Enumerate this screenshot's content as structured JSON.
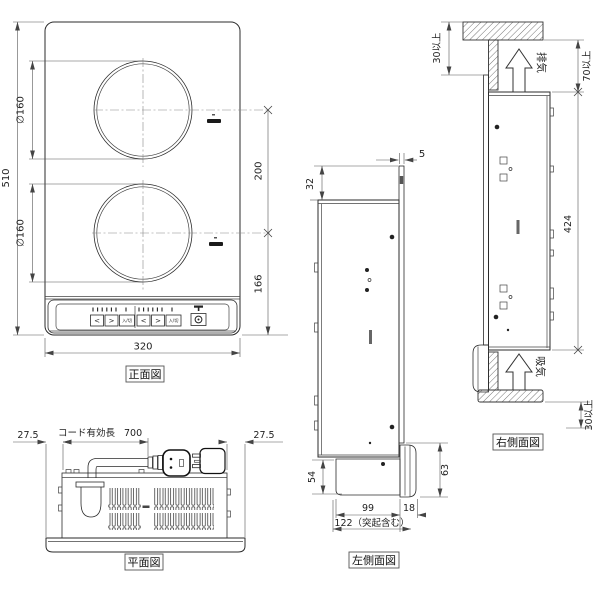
{
  "front": {
    "label": "正面図",
    "dims": {
      "height": "510",
      "burner_top": "∅160",
      "burner_bottom": "∅160",
      "pitch": "200",
      "offset": "166",
      "width": "320"
    },
    "panel": {
      "arrow_left": "<",
      "arrow_right": ">",
      "onoff": "入/切"
    }
  },
  "plan": {
    "label": "平面図",
    "dims": {
      "overhang_left": "27.5",
      "overhang_right": "27.5",
      "cord_label": "コード有効長",
      "cord_length": "700"
    }
  },
  "left_side": {
    "label": "左側面図",
    "dims": {
      "plate_thickness": "5",
      "flange": "32",
      "panel_height": "54",
      "front_height": "63",
      "body_depth": "99",
      "lip": "18",
      "total_depth": "122（突起含む）"
    }
  },
  "right_side": {
    "label": "右側面図",
    "dims": {
      "top_clearance": "30以上",
      "exhaust_clearance": "70以上",
      "body_height": "424",
      "bottom_clearance": "30以上"
    },
    "labels": {
      "exhaust": "排気",
      "intake": "吸気"
    }
  }
}
